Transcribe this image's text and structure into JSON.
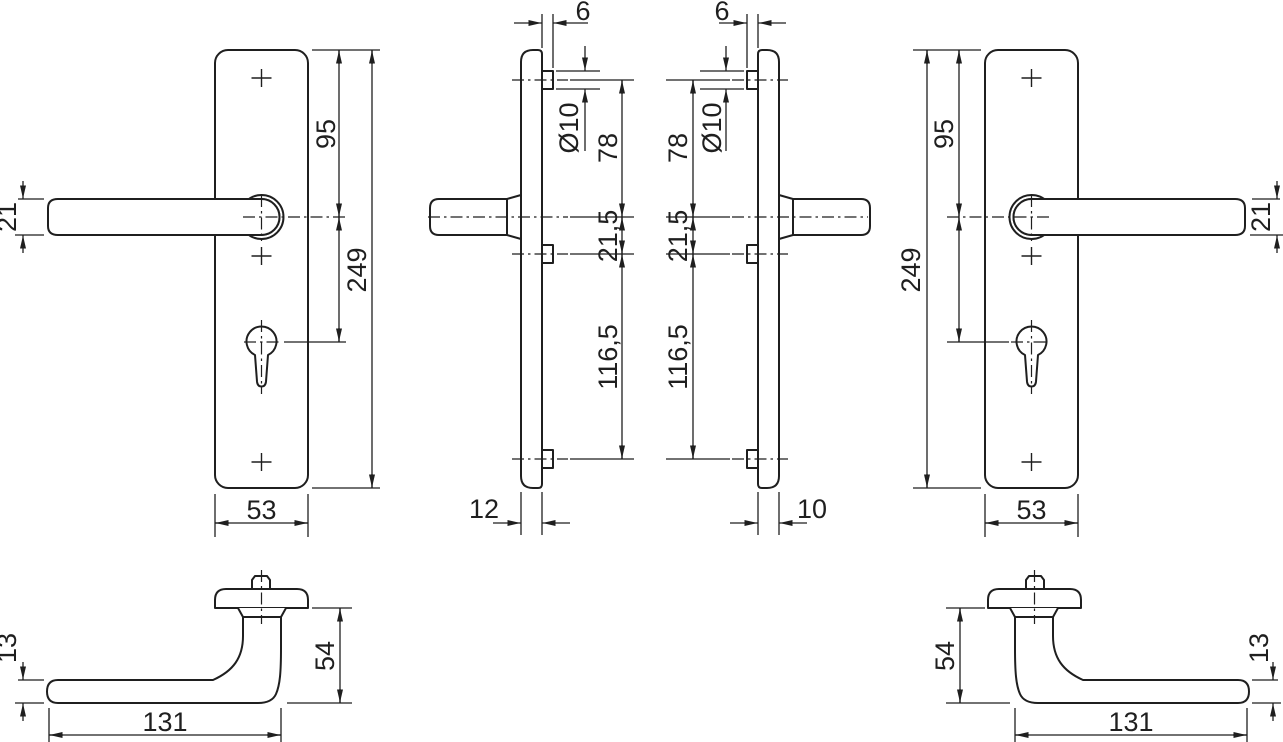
{
  "drawing": {
    "kind": "technical-dimension-drawing",
    "subject": "door-lever-handle-with-long-backplates",
    "background": "#ffffff",
    "line_color": "#1f1f1f",
    "views": {
      "front_plate_left": {
        "name": "backplate-front-view-left",
        "dims": {
          "lever_thickness": "21",
          "top_to_lever": "95",
          "plate_length": "249",
          "plate_width": "53"
        }
      },
      "side_plate_left": {
        "name": "backplate-side-view-left",
        "dims": {
          "stud_protrusion": "6",
          "stud_diameter": "Ø10",
          "stud_to_lever": "78",
          "lever_to_mid_stud": "21,5",
          "mid_to_bottom_stud": "116,5",
          "plate_thickness": "12"
        }
      },
      "side_plate_right": {
        "name": "backplate-side-view-right",
        "dims": {
          "stud_protrusion": "6",
          "stud_diameter": "Ø10",
          "stud_to_lever": "78",
          "lever_to_mid_stud": "21,5",
          "mid_to_bottom_stud": "116,5",
          "plate_thickness": "10"
        }
      },
      "front_plate_right": {
        "name": "backplate-front-view-right",
        "dims": {
          "lever_thickness": "21",
          "top_to_lever": "95",
          "plate_length": "249",
          "plate_width": "53"
        }
      },
      "handle_left": {
        "name": "lever-handle-side-view-left",
        "dims": {
          "grip_thickness": "13",
          "handle_height": "54",
          "handle_length": "131"
        }
      },
      "handle_right": {
        "name": "lever-handle-side-view-right",
        "dims": {
          "grip_thickness": "13",
          "handle_height": "54",
          "handle_length": "131"
        }
      }
    }
  }
}
